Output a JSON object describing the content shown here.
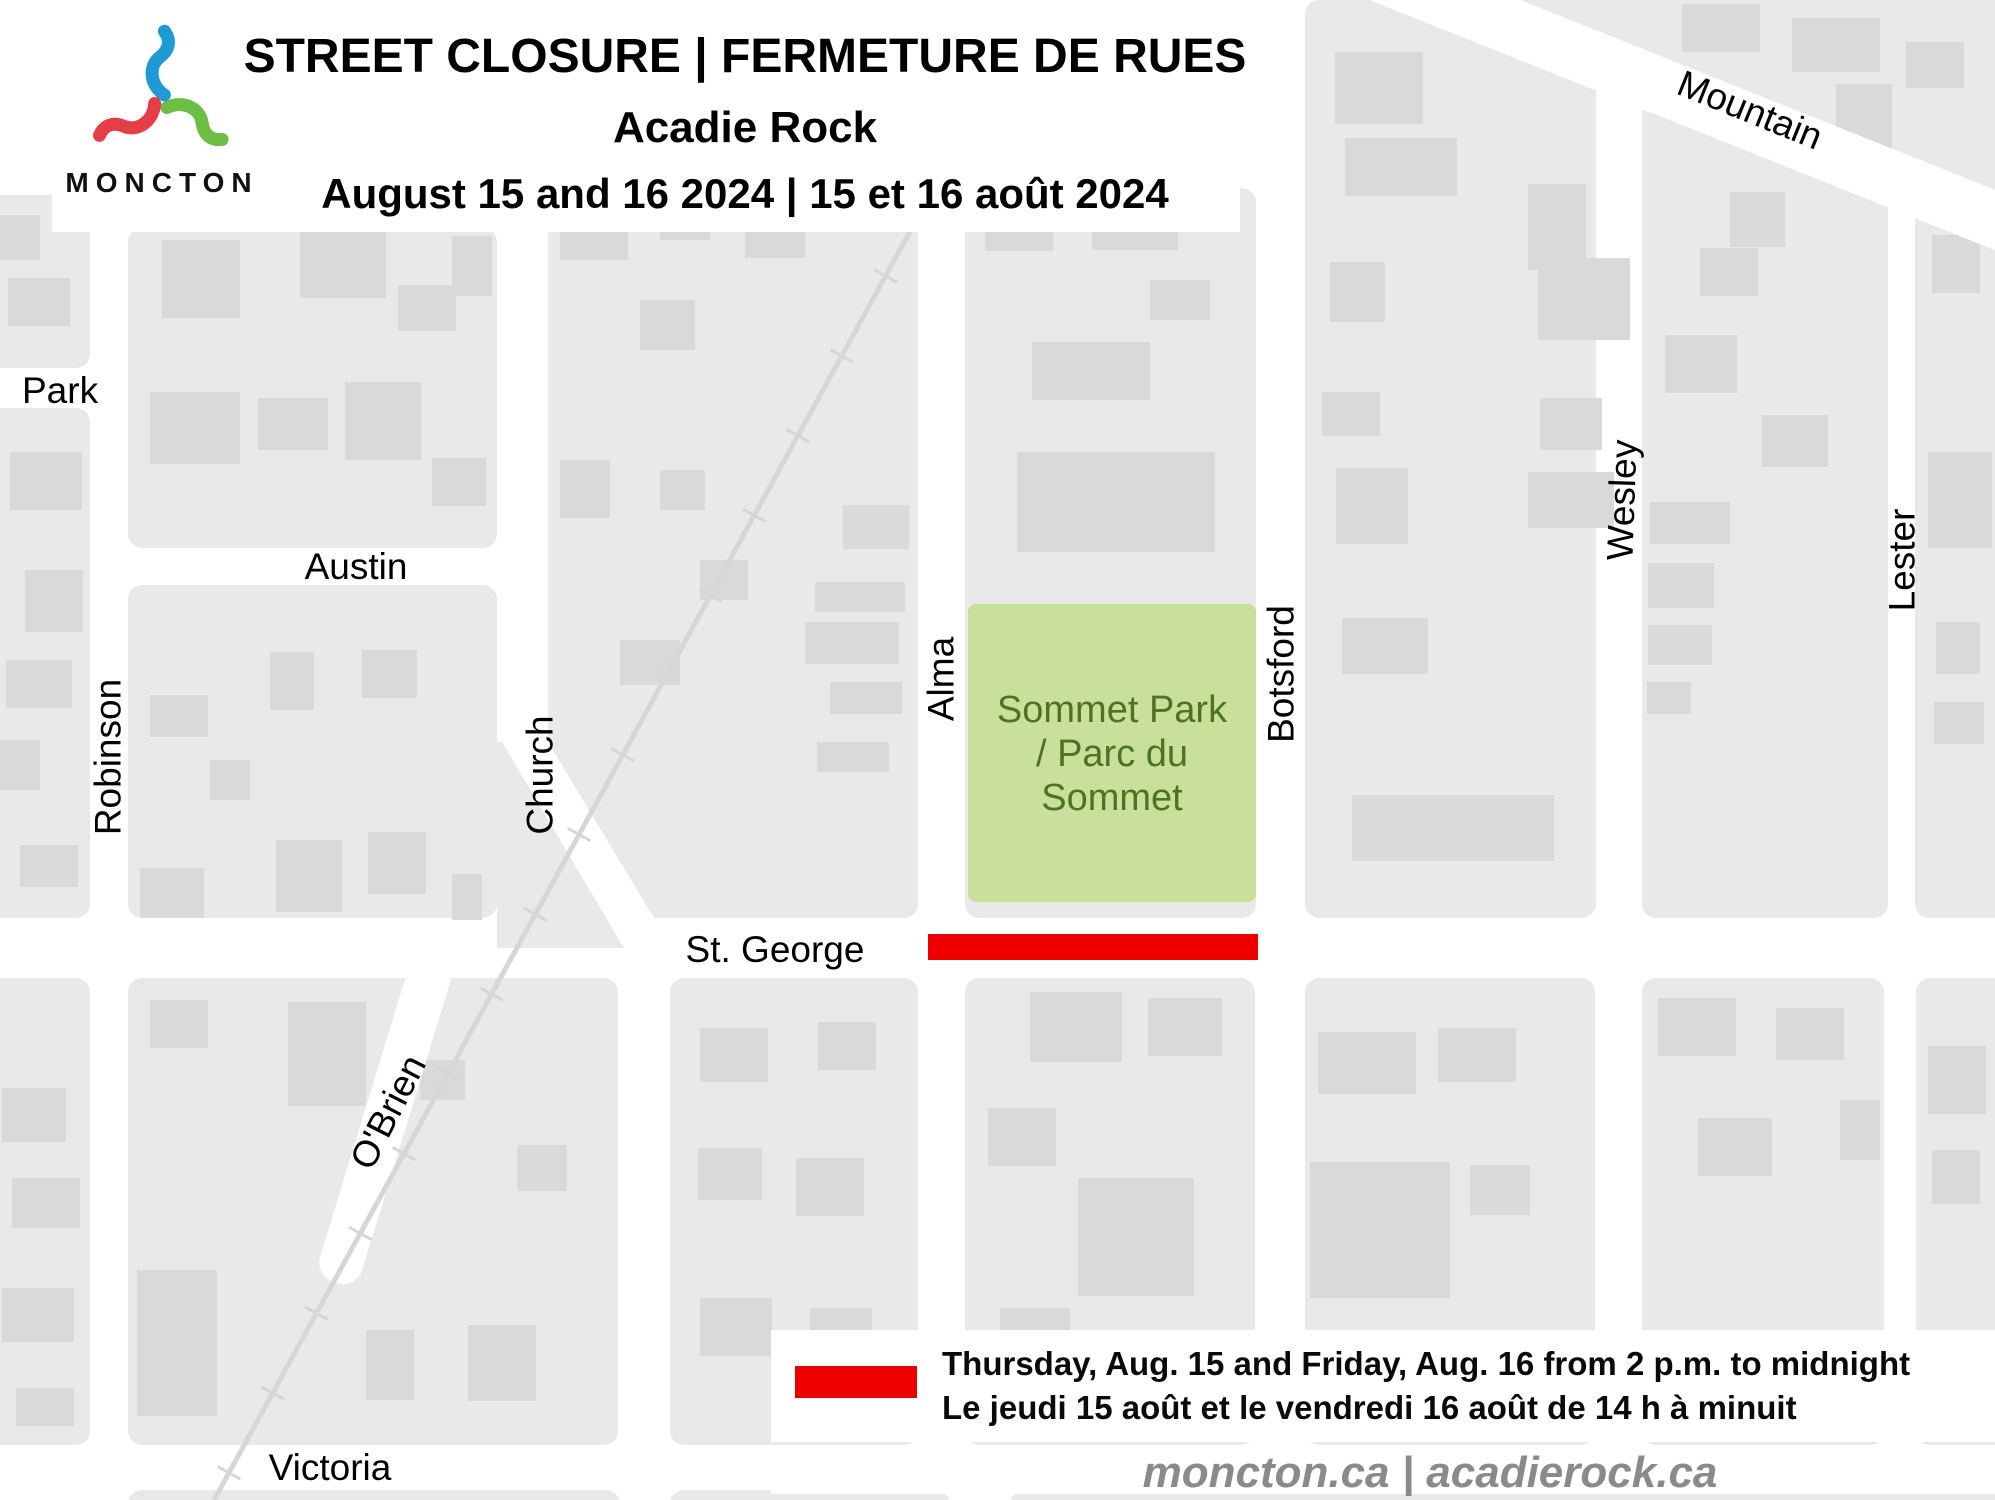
{
  "header": {
    "logo_text": "MONCTON",
    "title_line1": "STREET CLOSURE | FERMETURE DE RUES",
    "title_line2": "Acadie Rock",
    "title_line3": "August 15 and 16 2024 | 15 et 16 août 2024"
  },
  "map": {
    "street_labels": {
      "park": "Park",
      "austin": "Austin",
      "robinson": "Robinson",
      "church": "Church",
      "alma": "Alma",
      "botsford": "Botsford",
      "wesley": "Wesley",
      "lester": "Lester",
      "mountain": "Mountain",
      "st_george": "St. George",
      "obrien": "O'Brien",
      "victoria": "Victoria"
    },
    "park_label": {
      "line1": "Sommet Park",
      "line2": "/ Parc du",
      "line3": "Sommet"
    }
  },
  "legend": {
    "line1_en": "Thursday, Aug. 15 and Friday, Aug. 16 from 2 p.m. to midnight",
    "line2_fr": "Le jeudi 15 août et le vendredi 16 août de 14 h à minuit"
  },
  "footer": {
    "websites": "moncton.ca | acadierock.ca"
  },
  "colors": {
    "closure_red": "#ee0000",
    "park_green": "#c9e09c",
    "park_text": "#4e7420",
    "block_gray": "#e9e9e9",
    "building_gray": "#d9d9d9",
    "railway_gray": "#d6d6d6",
    "footer_text": "#8a8a8a",
    "logo_blue": "#1f9ad6",
    "logo_green": "#6cbe45",
    "logo_red": "#e63e47"
  }
}
